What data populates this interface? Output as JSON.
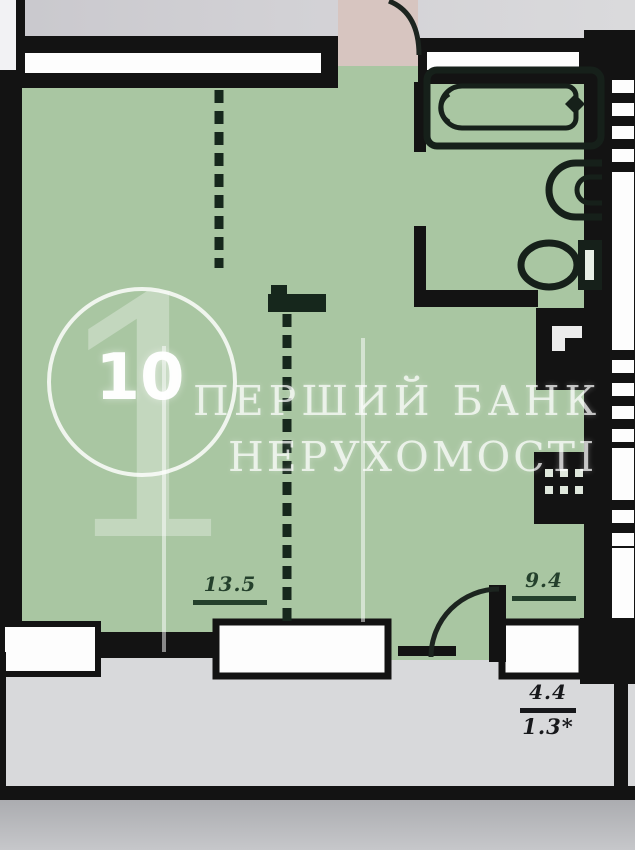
{
  "plan": {
    "unit_number": "10",
    "room_areas": {
      "living_room": "13.5",
      "kitchen": "9.4",
      "balcony": "4.4",
      "balcony_reduced": "1.3*"
    }
  },
  "watermark": {
    "numeral": "1",
    "line1": "ПЕРШИЙ БАНК",
    "line2": "НЕРУХОМОСТІ"
  },
  "colors": {
    "wall": "#131313",
    "room_fill": "#a9c6a2",
    "entry_fill": "#d7c5c0",
    "exterior": "#d2d1d5",
    "balcony_fill": "#d8d9db",
    "ground": "#b3b4b8",
    "dimension_text": "#24402c",
    "balcony_dimension_text": "#17181b",
    "watermark": "#ffffff"
  },
  "icons": [
    "bathtub-icon",
    "sink-icon",
    "toilet-icon",
    "vent-shaft-icon",
    "electric-panel-icon",
    "door-swing-arc"
  ]
}
